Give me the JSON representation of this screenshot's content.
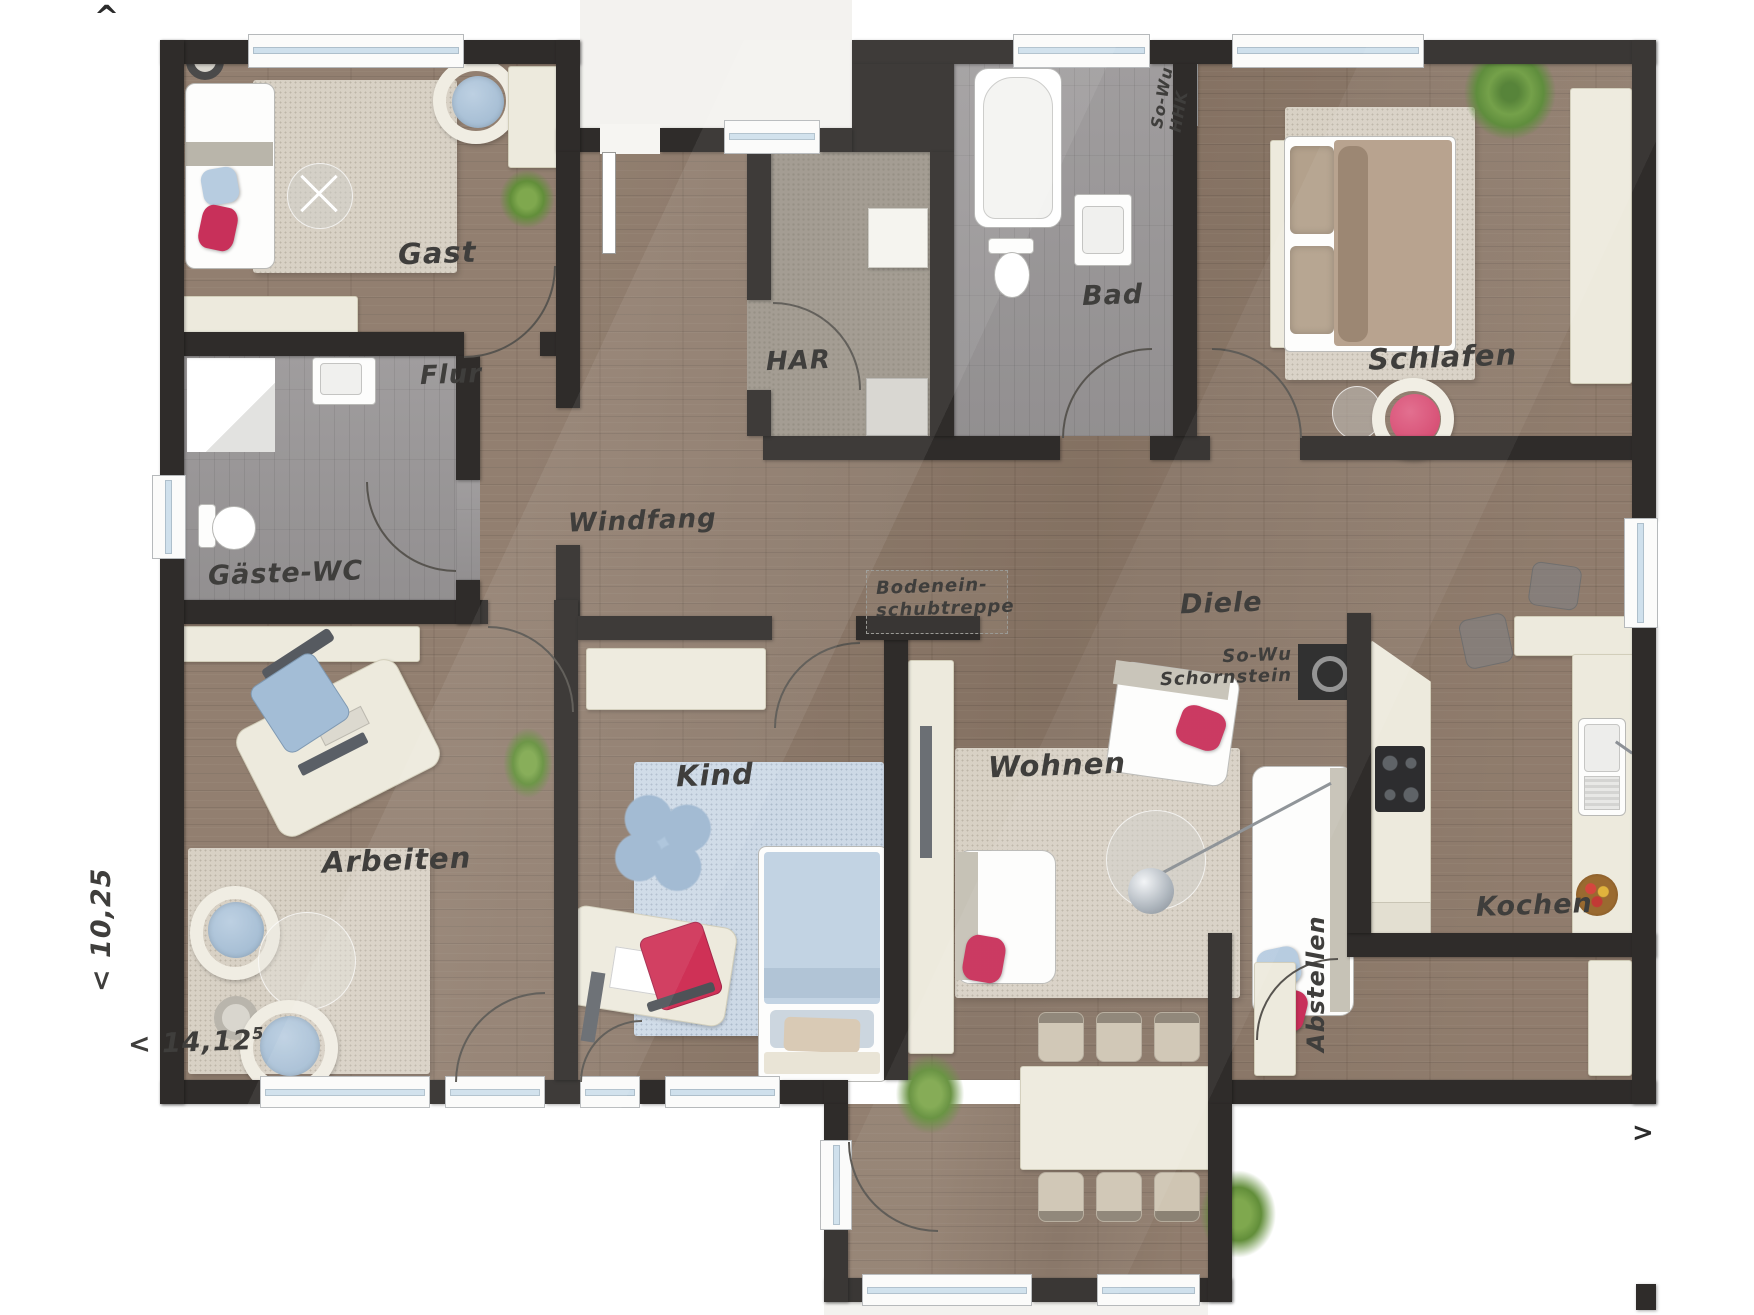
{
  "markers": {
    "north": "^",
    "east": ">"
  },
  "dimensions": {
    "width": "< 14,12",
    "width_sup": "5",
    "depth": "< 10,25"
  },
  "rooms": {
    "gast": "Gast",
    "flur": "Flur",
    "gaeste_wc": "Gäste-WC",
    "arbeiten": "Arbeiten",
    "windfang": "Windfang",
    "kind": "Kind",
    "har": "HAR",
    "bad": "Bad",
    "schlafen": "Schlafen",
    "diele": "Diele",
    "wohnen": "Wohnen",
    "kochen": "Kochen",
    "abstellen": "Abstellen"
  },
  "annotations": {
    "attic_stairs": [
      "Bodenein-",
      "schubtreppe"
    ],
    "bad_radiator": [
      "So-Wu",
      "HHK"
    ],
    "chimney": [
      "So-Wu",
      "Schornstein"
    ]
  },
  "colors": {
    "wall": "#2f2c2a",
    "wood_floor": "#8b7767",
    "tile_floor": "#9a9798",
    "accent_red": "#c8305a",
    "accent_blue": "#a9c4dc",
    "furniture_cream": "#edeadd",
    "rug_beige": "#d8d1c5",
    "rug_blue": "#cdd9e6"
  }
}
